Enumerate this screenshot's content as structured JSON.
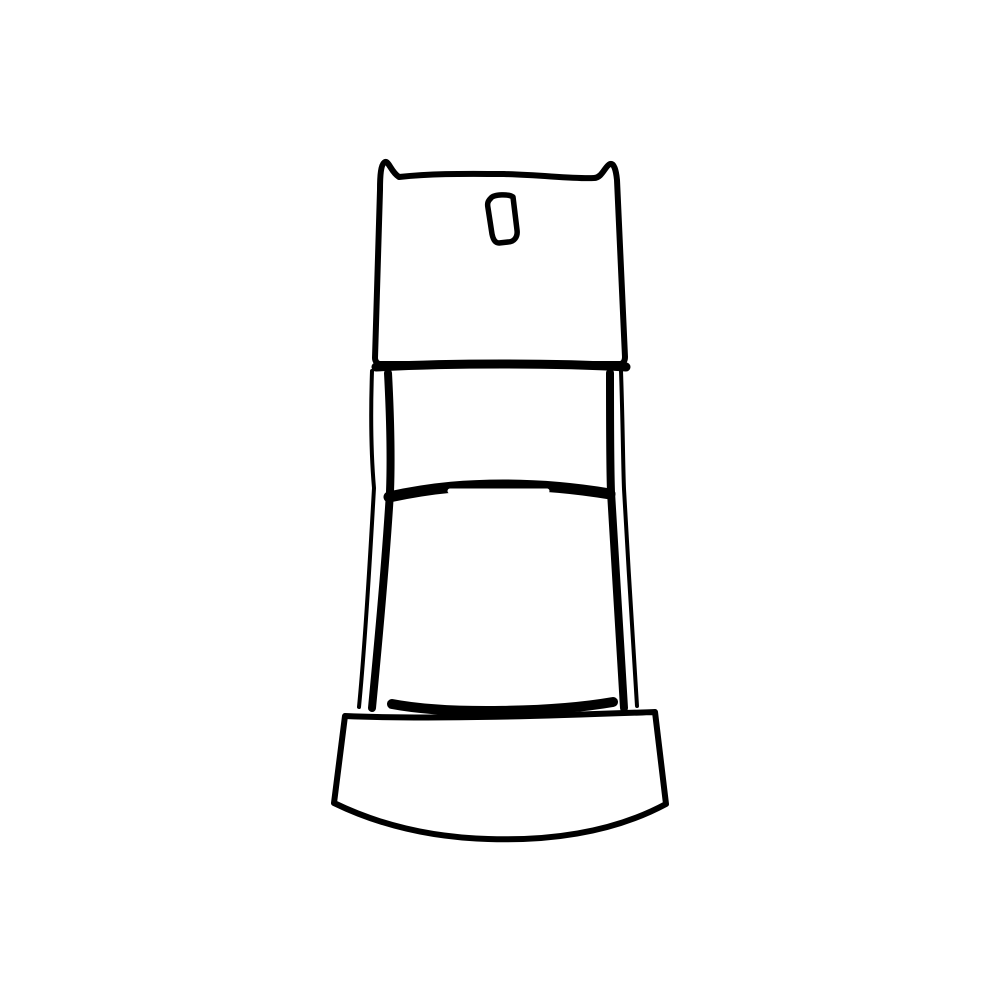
{
  "artwork": {
    "subject": "black-and-white line drawing of a pedestal machine (meter/dispenser style): boxy head with flared corners and a vertical coin slot, double-outlined flared column with a center divider bar and white highlight slot, wide curved rocker base",
    "background_color": "#ffffff",
    "colors": {
      "line": "#000000",
      "fill": "#ffffff",
      "highlight": "#ffffff"
    },
    "paths": {
      "head": "M375 358 L380 190 C380 175 381 164 385 162 C389 161 391 172 399 177 C438 173 472 174 504 174 C543 175 573 179 594 178 C602 178 605 166 610 164 C614 163 616 170 617 180 L625 357 C625 361 623 364 620 364 L380 364 C377 364 375 361 375 358 Z",
      "head_bottom_edge": "M376 367 C450 363 556 363 626 367",
      "coin_slot": "M491 198 C494 194 509 194 513 197 L517 230 C518 237 514 242 508 242 L499 243 C495 243 493 239 492 234 L488 208 C487 203 488 201 491 198 Z",
      "column_left_outer": "M372 371 C370 430 372 465 374 488 C370 560 365 645 359 707",
      "column_left_inner": "M388 373 C391 430 391 465 390 492 C385 575 377 655 372 708",
      "column_right_inner": "M610 373 C610 430 610 465 611 492 C616 575 621 655 624 708",
      "column_right_outer": "M621 371 C623 430 623 465 624 489 C628 560 633 645 637 706",
      "divider": "M389 497 C435 487 470 485 504 485 C546 485 580 489 610 494",
      "divider_highlight": "M450 491 L547 491",
      "column_bottom_edge": "M392 704 C450 715 555 712 613 702",
      "base": "M345 716 C440 720 570 715 655 712 L666 804 C612 833 548 841 488 839 C420 837 369 820 334 803 Z"
    }
  }
}
